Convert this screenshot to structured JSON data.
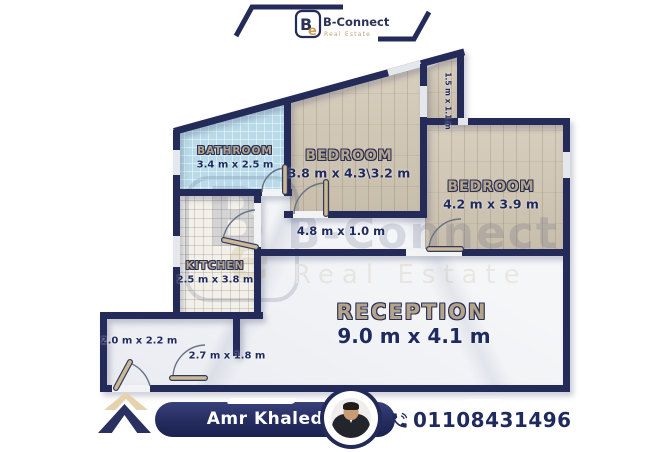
{
  "brand": {
    "name": "B-Connect",
    "tagline": "Real Estate",
    "mark_b": "B",
    "mark_e": "e"
  },
  "colors": {
    "navy": "#242b58",
    "gold": "#c2a36f",
    "label_tan": "#b5a48b",
    "bath_blue": "#b9dbe9",
    "wood": "#d2c7b4"
  },
  "icons": {
    "brand_mark": "b-connect-monogram-icon",
    "footer_phone": "phone-icon",
    "footer_logo": "double-chevron-up-icon"
  },
  "floorplan": {
    "rooms": [
      {
        "id": "bathroom",
        "name": "BATHROOM",
        "dims": "3.4 m x 2.5 m"
      },
      {
        "id": "bedroom-1",
        "name": "BEDROOM",
        "dims": "3.8 m x 4.3\\3.2 m"
      },
      {
        "id": "bedroom-2",
        "name": "BEDROOM",
        "dims": "4.2 m x 3.9 m"
      },
      {
        "id": "kitchen",
        "name": "KITCHEN",
        "dims": "2.5 m x 3.8 m"
      },
      {
        "id": "reception",
        "name": "RECEPTION",
        "dims": "9.0 m x 4.1 m"
      },
      {
        "id": "corridor",
        "dims": "4.8 m x 1.0 m"
      },
      {
        "id": "entry",
        "dims": "2.0 m x 2.2 m"
      },
      {
        "id": "passage",
        "dims": "2.7 m x 1.8 m"
      },
      {
        "id": "balcony",
        "dims": "1.5 m x 1.1 m"
      }
    ]
  },
  "footer": {
    "agent_name": "Amr Khaled",
    "phone": "01108431496"
  }
}
